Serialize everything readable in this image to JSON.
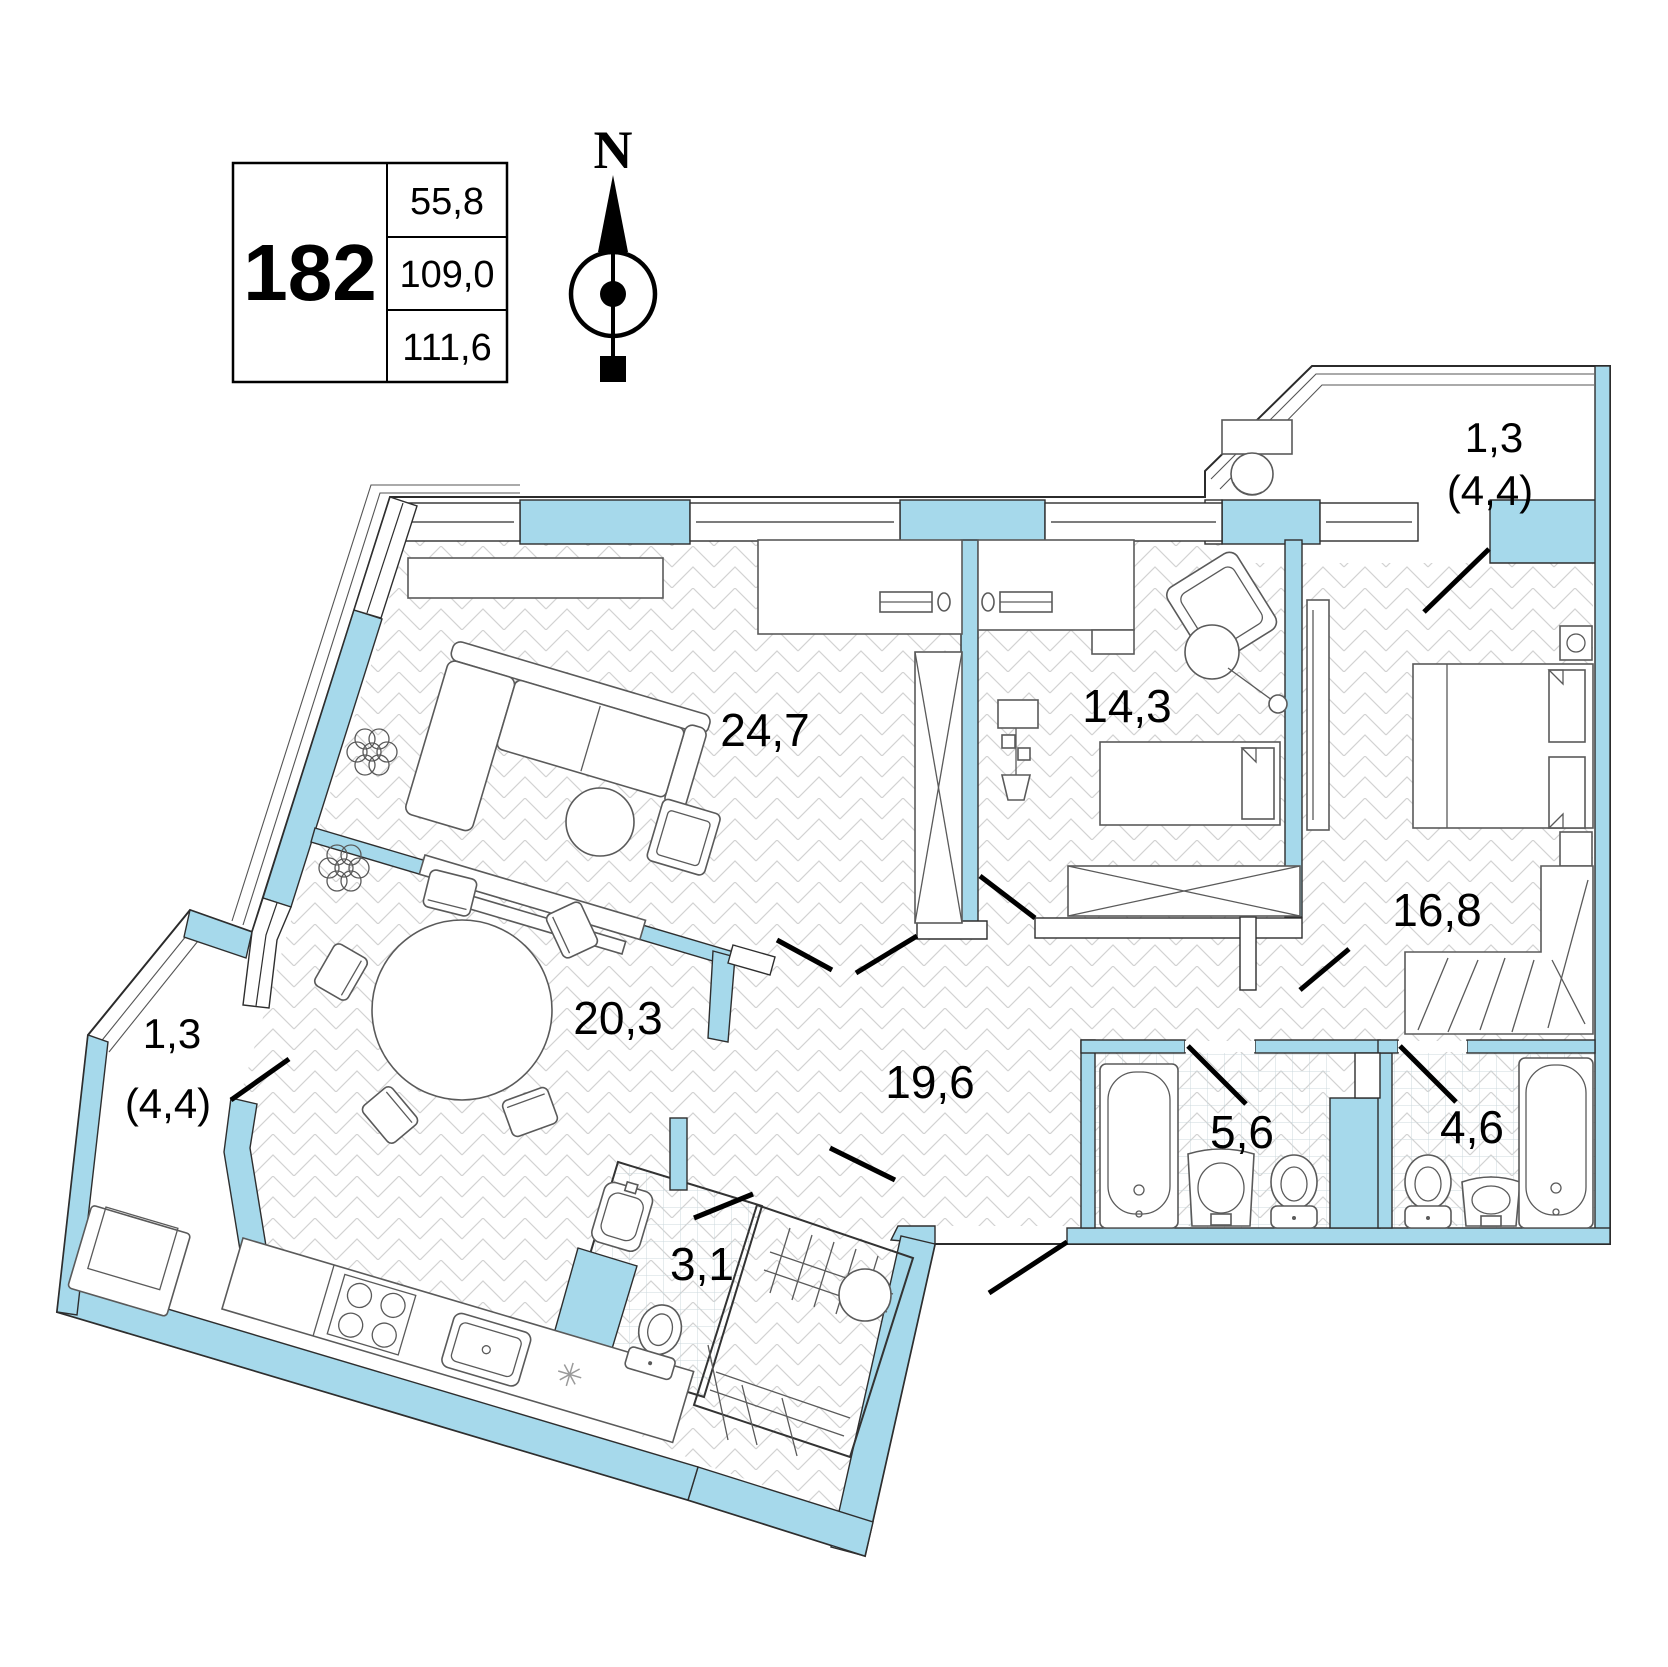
{
  "legend": {
    "unit_number": "182",
    "rows": [
      "55,8",
      "109,0",
      "111,6"
    ]
  },
  "compass": {
    "north_label": "N"
  },
  "rooms": {
    "living": {
      "area": "24,7"
    },
    "bedroom1": {
      "area": "14,3"
    },
    "bedroom2": {
      "area": "16,8"
    },
    "dining": {
      "area": "20,3"
    },
    "hallway": {
      "area": "19,6"
    },
    "bathroom1": {
      "area": "5,6"
    },
    "bathroom2": {
      "area": "4,6"
    },
    "wc": {
      "area": "3,1"
    },
    "balcony_top": {
      "area": "1,3",
      "area_total": "(4,4)"
    },
    "balcony_left": {
      "area": "1,3",
      "area_total": "(4,4)"
    }
  },
  "colors": {
    "wall": "#A6D9EB",
    "line": "#2e2e2e",
    "floor_hatch": "#d2d2d2",
    "tile": "#ccd9dd"
  }
}
